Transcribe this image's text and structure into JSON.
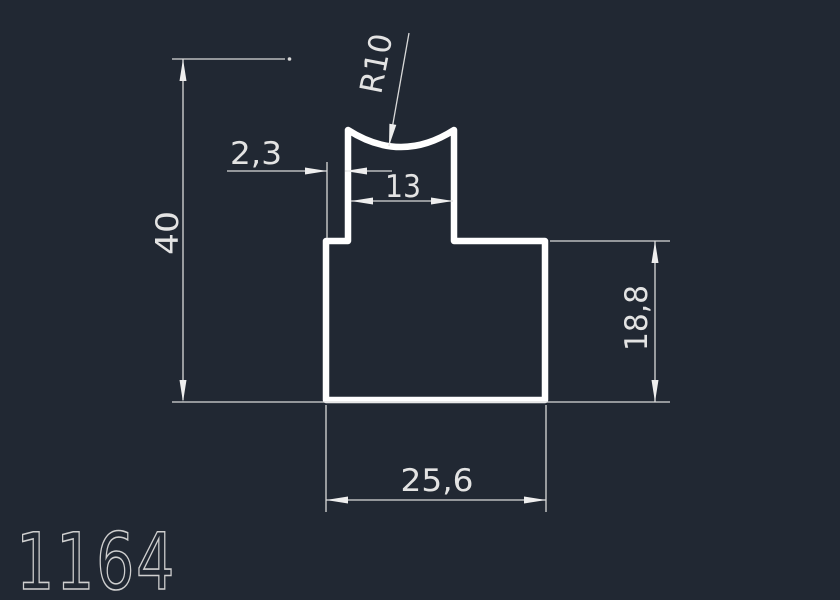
{
  "drawing": {
    "part_number": "1164",
    "dimensions": {
      "overall_height": "40",
      "overall_width": "25,6",
      "body_height": "18,8",
      "neck_width": "13",
      "step_width": "2,3",
      "top_radius": "R10"
    },
    "colors": {
      "background": "#212833",
      "profile_line": "#ffffff",
      "dimension_line": "#d9d9d9",
      "dimension_text": "#e3e3e3",
      "part_number_text": "#cfcfcf"
    }
  }
}
